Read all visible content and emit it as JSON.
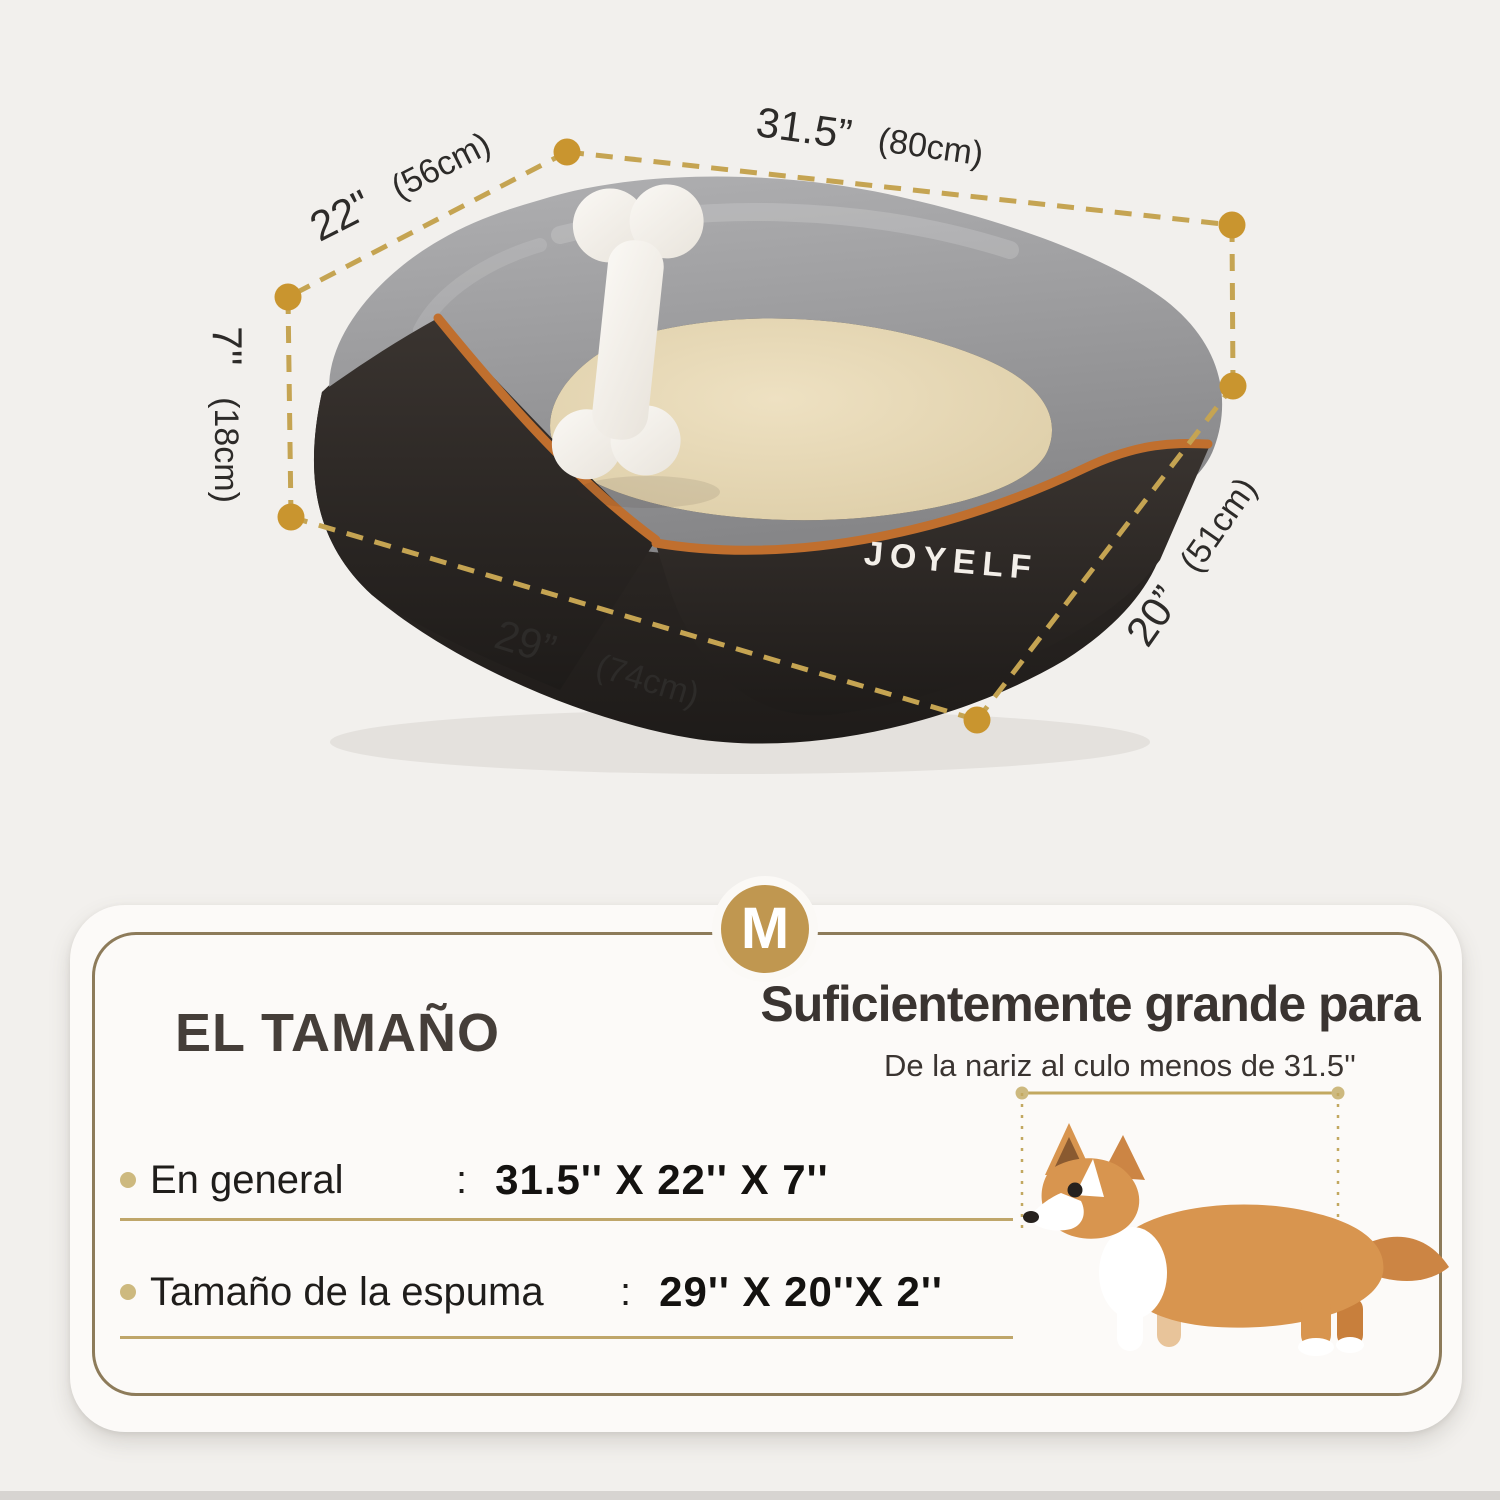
{
  "brand": "JOYELF",
  "bed_dimensions": {
    "top_width": {
      "value": "31.5”",
      "cm": "(80cm)"
    },
    "top_depth": {
      "value": "22\"",
      "cm": "(56cm)"
    },
    "height": {
      "value": "7''",
      "cm": "(18cm)"
    },
    "front_width": {
      "value": "29”",
      "cm": "(74cm)"
    },
    "side_depth": {
      "value": "20”",
      "cm": "(51cm)"
    }
  },
  "size_panel": {
    "badge": "M",
    "title": "EL TAMAÑO",
    "heading": "Suficientemente grande para",
    "subheading": "De la nariz al culo menos de 31.5''",
    "rows": [
      {
        "label": "En general",
        "colon": ":",
        "value": "31.5'' X 22'' X 7''"
      },
      {
        "label": "Tamaño de la espuma",
        "colon": ":",
        "value": "29'' X 20''X 2''"
      }
    ]
  },
  "colors": {
    "accent_dot_gold": "#c9952f",
    "dash_tan": "#c5a452",
    "panel_border_tan": "#8d7b5a",
    "badge_gold": "#c09750",
    "piping_orange": "#c06f2e"
  }
}
